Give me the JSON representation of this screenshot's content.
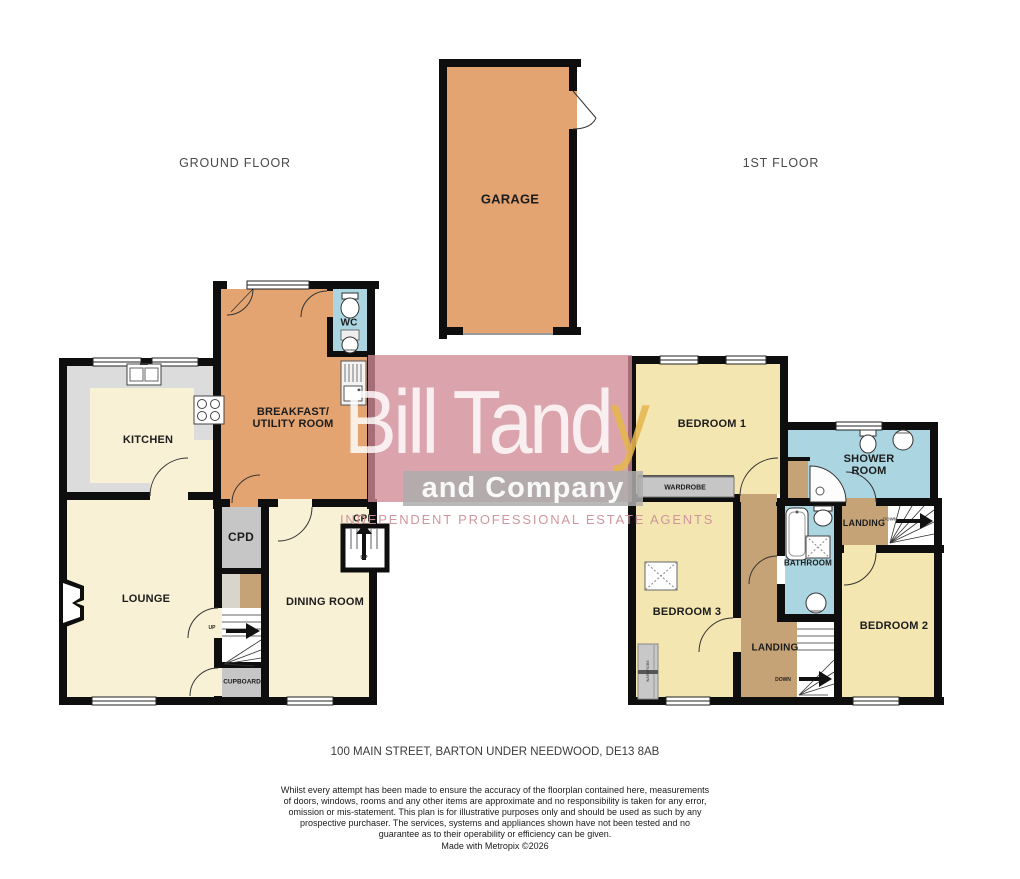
{
  "ground": {
    "title": "GROUND FLOOR",
    "labels": {
      "garage": "GARAGE",
      "breakfast_line1": "BREAKFAST/",
      "breakfast_line2": "UTILITY ROOM",
      "wc": "WC",
      "kitchen": "KITCHEN",
      "lounge": "LOUNGE",
      "cpd": "CPD",
      "cupboard": "CUPBOARD",
      "dining": "DINING ROOM",
      "cpd_small": "CPD",
      "up_main": "UP",
      "up_small": "UP"
    }
  },
  "first": {
    "title": "1ST FLOOR",
    "labels": {
      "bedroom1": "BEDROOM 1",
      "bedroom2": "BEDROOM 2",
      "bedroom3": "BEDROOM 3",
      "shower_line1": "SHOWER",
      "shower_line2": "ROOM",
      "bathroom": "BATHROOM",
      "landing_upper": "LANDING",
      "down_upper": "DOWN",
      "landing_lower": "LANDING",
      "down_lower": "DOWN",
      "wardrobe": "WARDROBE",
      "wardrobe_small": "WARDROBE"
    }
  },
  "watermark": {
    "brand_main": "Bill Tand",
    "brand_accent": "y",
    "brand_sub": "and Company",
    "tagline": "INDEPENDENT PROFESSIONAL ESTATE AGENTS"
  },
  "footer": {
    "address": "100 MAIN STREET, BARTON UNDER NEEDWOOD, DE13 8AB",
    "disclaimer": "Whilst every attempt has been made to ensure the accuracy of the floorplan contained here, measurements of doors, windows, rooms and any other items are approximate and no responsibility is taken for any error, omission or mis-statement. This plan is for illustrative purposes only and should be used as such by any prospective purchaser. The services, systems and appliances shown have not been tested and no guarantee as to their operability or efficiency can be given.",
    "credit": "Made with Metropix ©2026"
  },
  "colors": {
    "room_orange": "#E3A471",
    "room_cream": "#F8F1D6",
    "room_yellow": "#F3E6B0",
    "room_blue": "#ABD5E1",
    "room_tan": "#C6A376",
    "room_gray": "#C6C6C6",
    "counter_gray": "#DCDCDC",
    "wall_black": "#0E0E0E",
    "watermark_pink": "#D18A96",
    "watermark_gold": "#E5B64D",
    "watermark_gray": "#ADADAD"
  }
}
